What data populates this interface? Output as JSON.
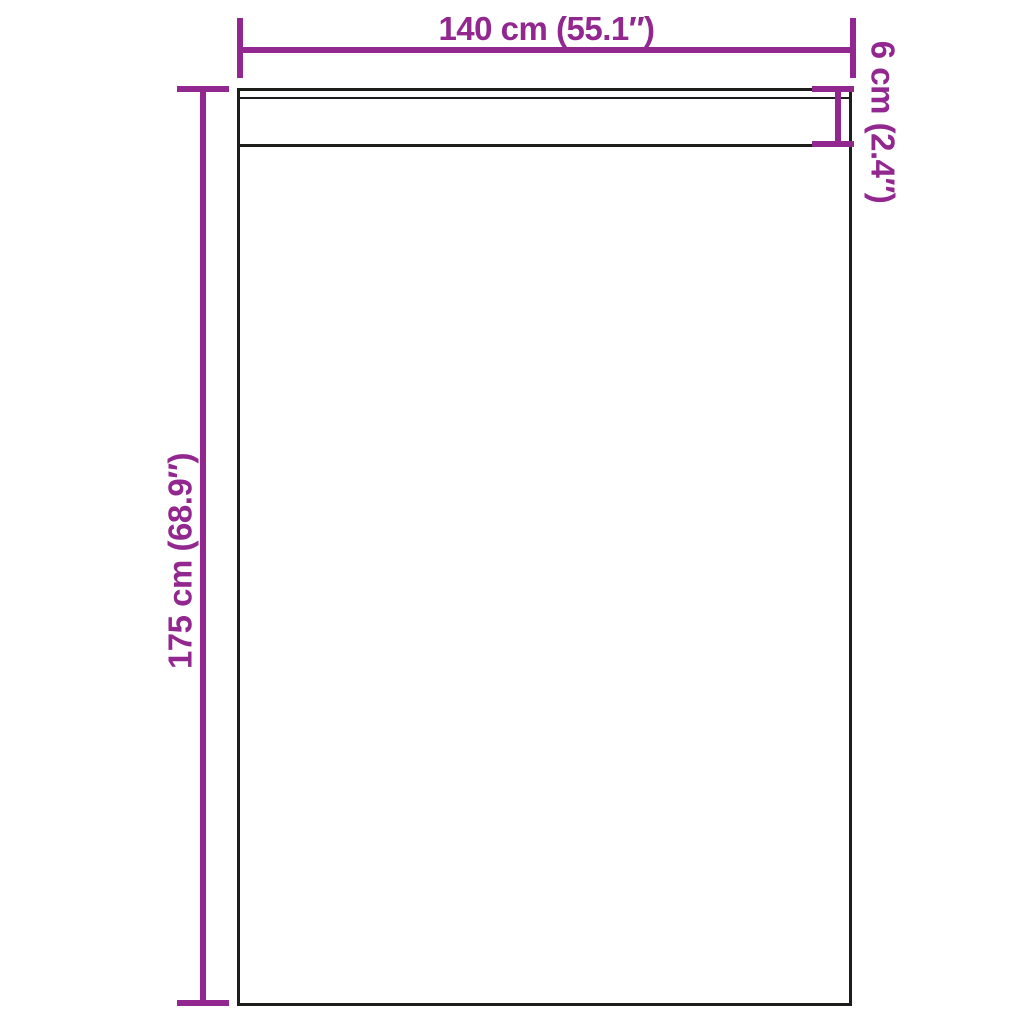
{
  "colors": {
    "dimension": "#92278F",
    "outline": "#1d1d1b",
    "background": "#ffffff"
  },
  "diagram": {
    "type": "product-dimension-diagram",
    "dimensions": {
      "width": {
        "label": "140 cm (55.1″)",
        "value_cm": 140,
        "value_in": 55.1
      },
      "height": {
        "label": "175 cm (68.9″)",
        "value_cm": 175,
        "value_in": 68.9
      },
      "header_height": {
        "label": "6 cm (2.4″)",
        "value_cm": 6,
        "value_in": 2.4
      }
    }
  }
}
